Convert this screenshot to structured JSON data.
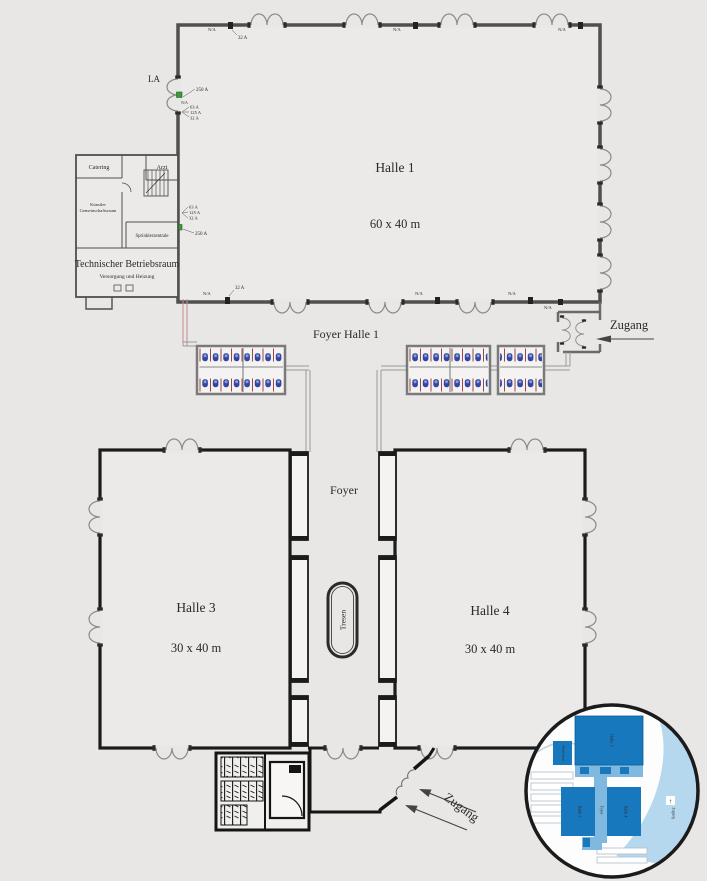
{
  "plan": {
    "halle1": {
      "label": "Halle 1",
      "dims": "60 x 40 m"
    },
    "halle3": {
      "label": "Halle 3",
      "dims": "30 x 40 m"
    },
    "halle4": {
      "label": "Halle 4",
      "dims": "30 x 40 m"
    },
    "foyer_halle1_label": "Foyer Halle 1",
    "foyer_label": "Foyer",
    "tresen_label": "Tresen",
    "zugang_label": "Zugang",
    "la_label": "LA"
  },
  "annex": {
    "catering": "Catering",
    "arzt": "Arzt",
    "kuenstler_line1": "Künstler",
    "kuenstler_line2": "Gemeinschaftsraum",
    "sprinkler": "Sprinklerzentrale",
    "technik": "Technischer Betriebsraum",
    "technik_sub": "Versorgung und Heizung"
  },
  "electrical": {
    "na": "N/A",
    "a32": "32 A",
    "a63": "63 A",
    "a125": "125 A",
    "a250": "250 A"
  },
  "inset": {
    "halle1": "Halle 1",
    "halle3": "Halle 3",
    "halle4": "Halle 4",
    "foyer": "Foyer",
    "betriebsraum": "Betriebsraum",
    "zugang": "Zugang",
    "arrow": "↑"
  },
  "colors": {
    "background": "#e8e7e5",
    "wall_gray": "#4f4f4f",
    "wall_black": "#1b1b1b",
    "marker_red": "#bb2222",
    "connector_green": "#3a9a3a",
    "fixture_blue": "#3347a2",
    "partition_red": "#9a4a42",
    "inset_dark_blue": "#1878bd",
    "inset_mid_blue": "#7fb9e0",
    "inset_light_blue": "#b5d8ef"
  }
}
